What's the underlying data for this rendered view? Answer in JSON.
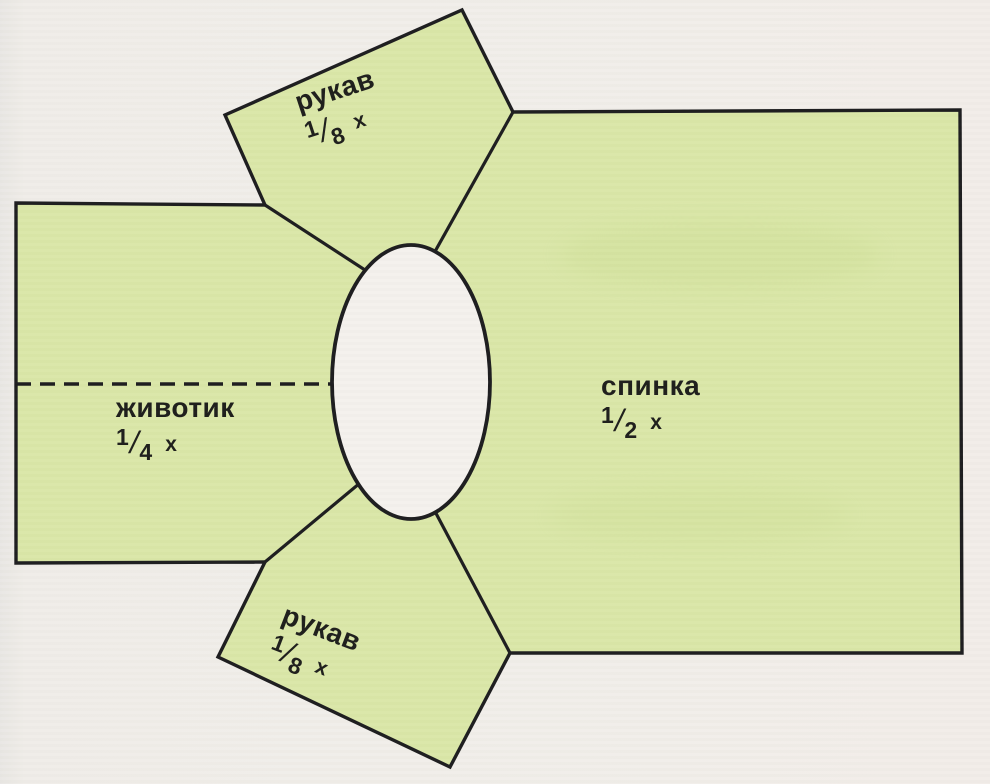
{
  "diagram": {
    "description": "garment pattern layout with neck opening",
    "colors": {
      "background": "#f1eeea",
      "piece_fill": "#dae7a8",
      "outline": "#1c1c1e",
      "neck_opening_fill": "#f4f1ed",
      "text": "#1d1d1b"
    },
    "pieces": {
      "sleeve_top": {
        "name": "рукав",
        "fraction": {
          "numerator": "1",
          "slash": "/",
          "denominator": "8",
          "suffix": "x"
        }
      },
      "back": {
        "name": "спинка",
        "fraction": {
          "numerator": "1",
          "slash": "/",
          "denominator": "2",
          "suffix": "x"
        }
      },
      "belly": {
        "name": "животик",
        "fraction": {
          "numerator": "1",
          "slash": "/",
          "denominator": "4",
          "suffix": "x"
        }
      },
      "sleeve_bottom": {
        "name": "рукав",
        "fraction": {
          "numerator": "1",
          "slash": "/",
          "denominator": "8",
          "suffix": "x"
        }
      }
    }
  }
}
